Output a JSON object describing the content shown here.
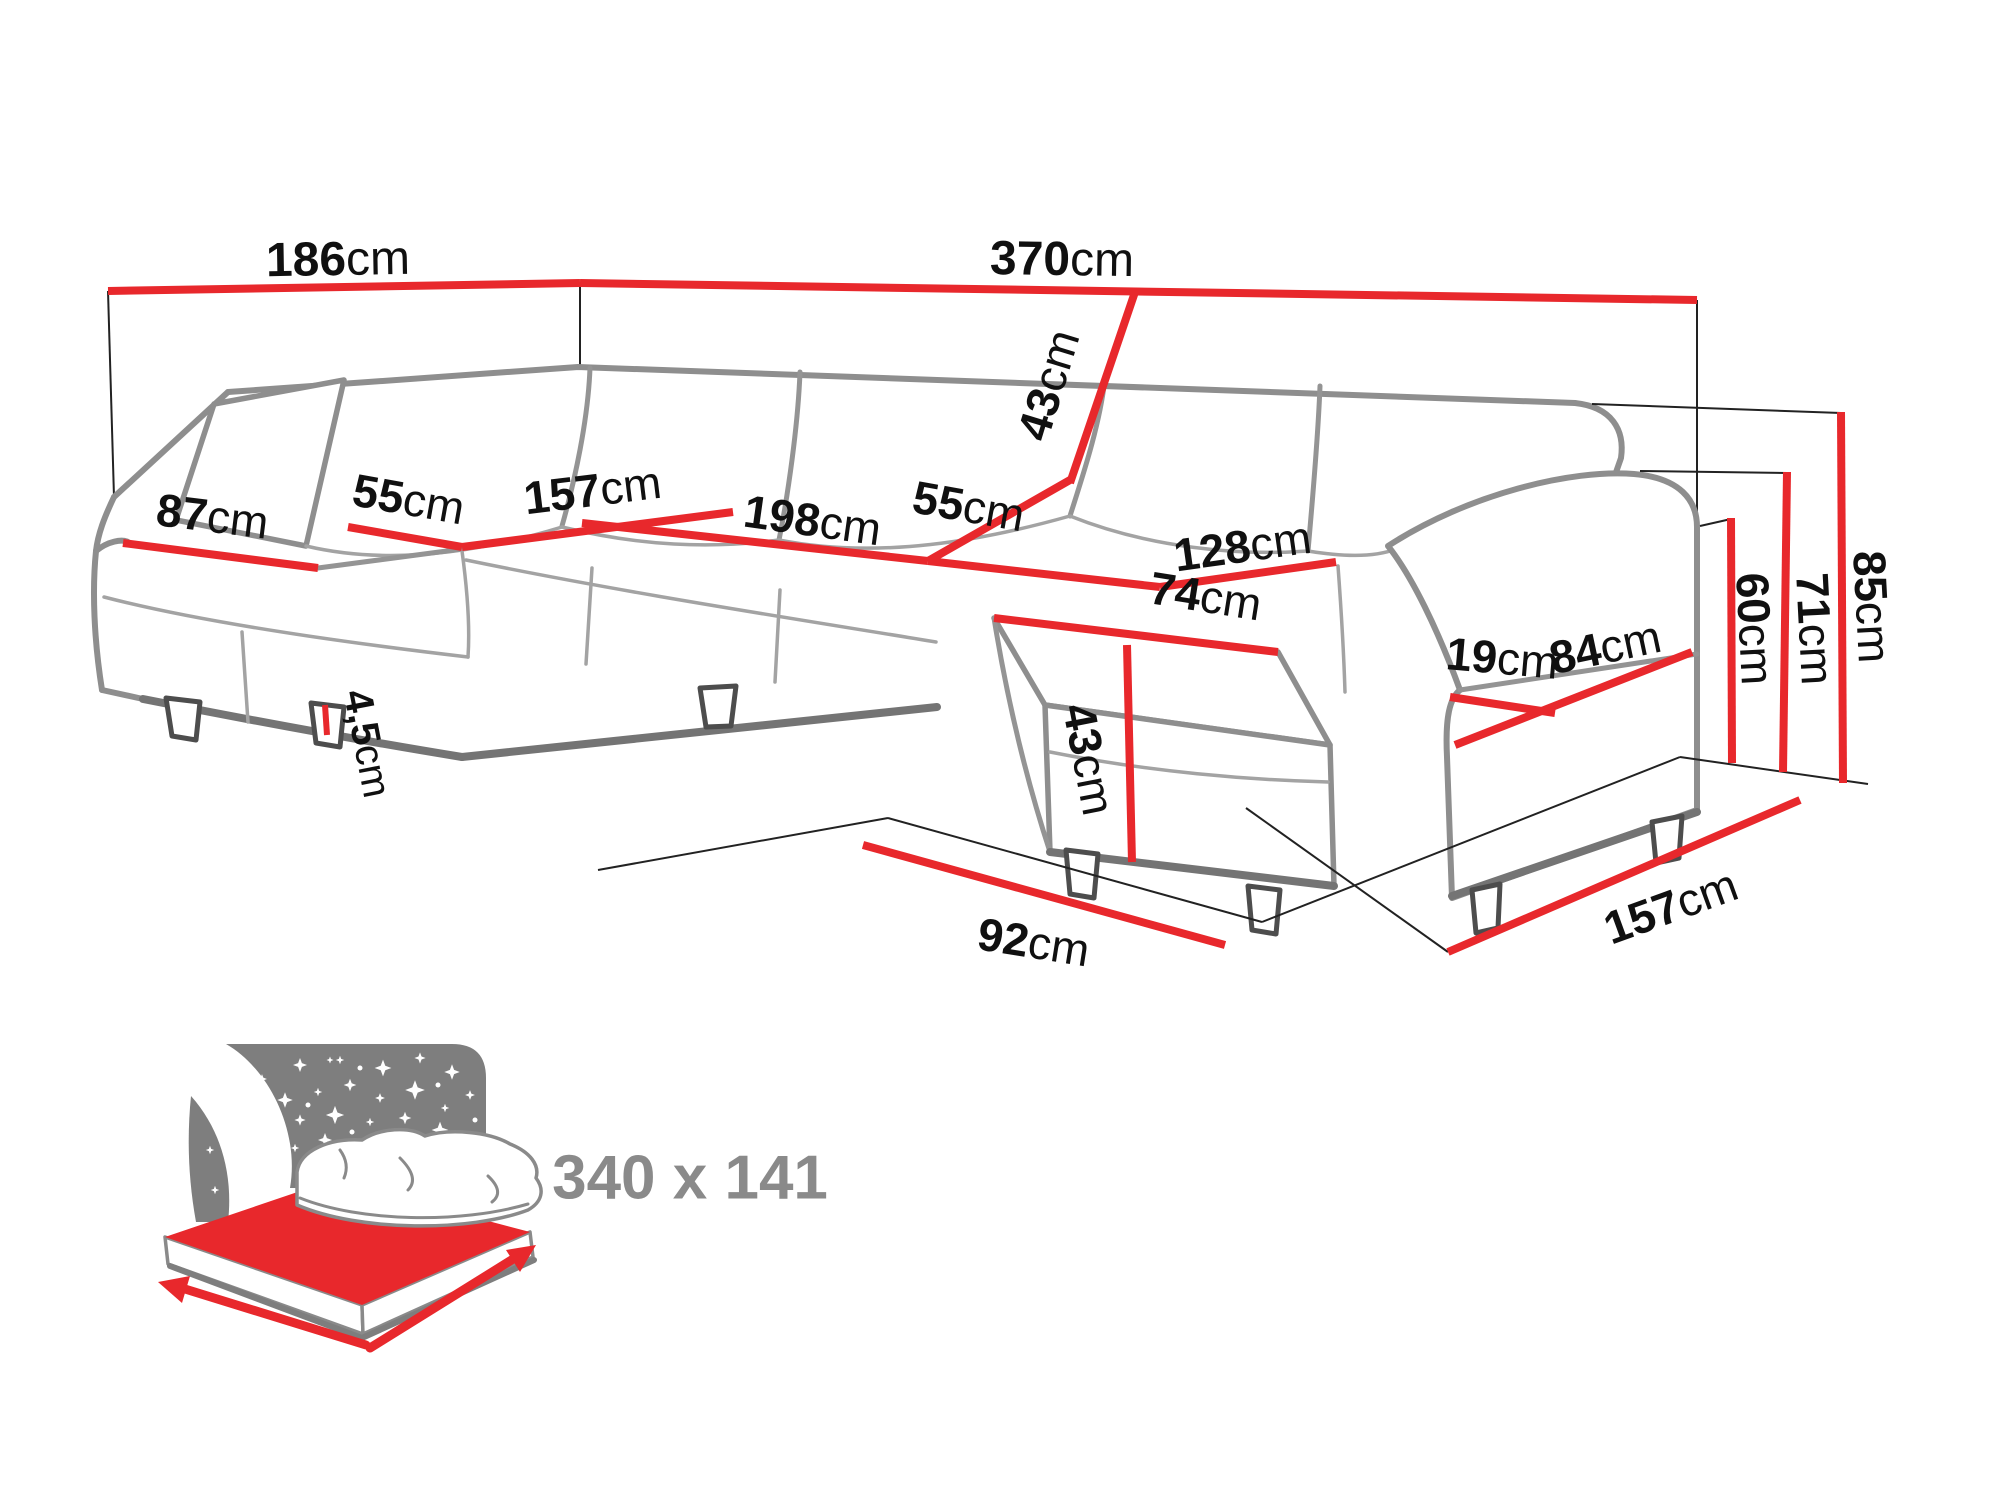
{
  "colors": {
    "dimension_red": "#e8282c",
    "outline_gray": "#8e8e8e",
    "icon_gray": "#7e7e7e",
    "label_black": "#101010",
    "icon_text_gray": "#8a8a8a",
    "background": "#ffffff"
  },
  "diagram": {
    "unit": "cm",
    "dimensions": {
      "wall_left": {
        "value": "186",
        "unit": "cm"
      },
      "wall_back": {
        "value": "370",
        "unit": "cm"
      },
      "chaise_width": {
        "value": "87",
        "unit": "cm"
      },
      "seat_depth_left": {
        "value": "55",
        "unit": "cm"
      },
      "seat_width_corner": {
        "value": "157",
        "unit": "cm"
      },
      "seat_width_middle": {
        "value": "198",
        "unit": "cm"
      },
      "seat_depth_right": {
        "value": "55",
        "unit": "cm"
      },
      "backrest_height": {
        "value": "43",
        "unit": "cm"
      },
      "seat_width_right": {
        "value": "128",
        "unit": "cm"
      },
      "ottoman_width": {
        "value": "74",
        "unit": "cm"
      },
      "ottoman_height": {
        "value": "43",
        "unit": "cm"
      },
      "armrest_width": {
        "value": "19",
        "unit": "cm"
      },
      "armrest_length": {
        "value": "84",
        "unit": "cm"
      },
      "leg_height": {
        "value": "4,5",
        "unit": "cm"
      },
      "ottoman_floor_depth": {
        "value": "92",
        "unit": "cm"
      },
      "side_floor_depth": {
        "value": "157",
        "unit": "cm"
      },
      "seat_height": {
        "value": "60",
        "unit": "cm"
      },
      "armrest_height": {
        "value": "71",
        "unit": "cm"
      },
      "total_height": {
        "value": "85",
        "unit": "cm"
      }
    },
    "sleeping_function": {
      "size_label": "340 x 141"
    }
  }
}
